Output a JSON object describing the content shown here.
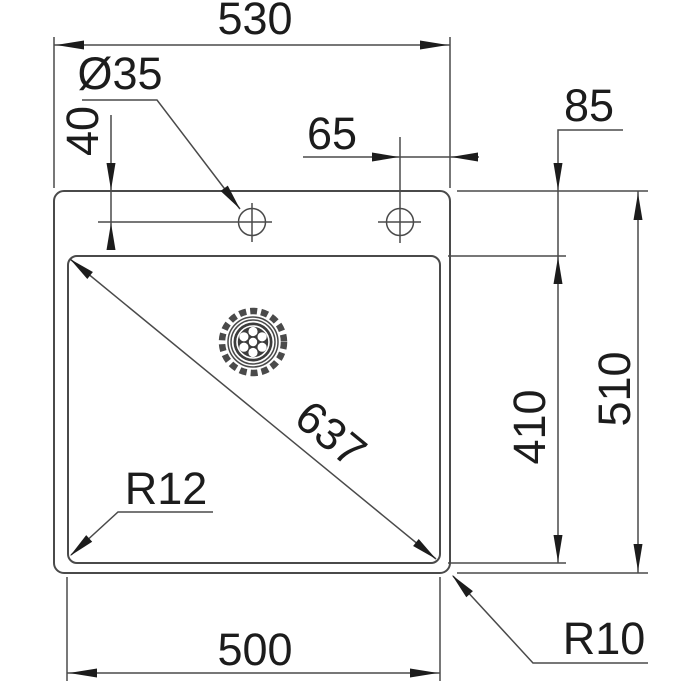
{
  "drawing": {
    "subject": "sink-installation-dimension-drawing",
    "labels": {
      "overall_width": "530",
      "hole_diameter": "Ø35",
      "hole_top_offset": "40",
      "hole_right_offset": "65",
      "rim_to_bowl_top": "85",
      "overall_depth": "510",
      "bowl_depth": "410",
      "bowl_diagonal": "637",
      "bowl_corner_radius": "R12",
      "outer_corner_radius": "R10",
      "bowl_width": "500"
    },
    "colors": {
      "line": "#4a4a4a",
      "text": "#1c1c1c",
      "background": "#ffffff"
    }
  }
}
